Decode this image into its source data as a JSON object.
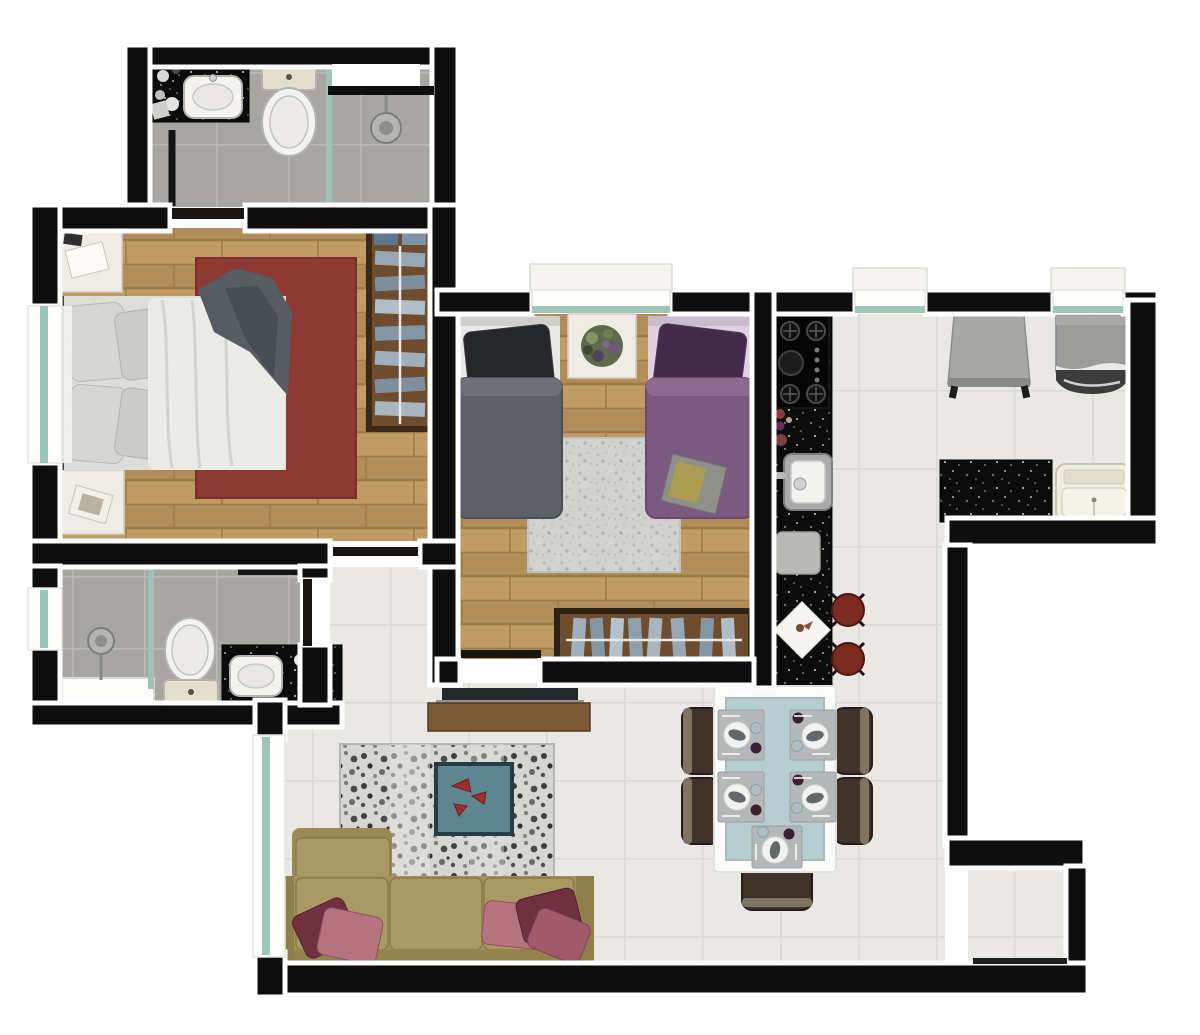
{
  "meta": {
    "type": "floor-plan",
    "description": "Top-down 3D rendered apartment floor plan, two bedrooms, two bathrooms, open kitchen-living-dining and service area",
    "visible_text": "none"
  },
  "palette": {
    "wall": "#0e0e0e",
    "wall_outline": "#ffffff",
    "glass": "#9cc4b9",
    "marble": "#f5f4f0",
    "wood": "#c09b64",
    "wood_dark": "#b28d58",
    "tile_bath": "#a8a6a3",
    "tile_light": "#e9e8e4",
    "rug_red": "#8c3a33",
    "rug_gray": "#d2d2d0",
    "sofa": "#a3935f",
    "pillow_dark": "#6f3040",
    "pillow_light": "#b3737f",
    "bed_gray_duvet": "#5e6067",
    "bed_gray_pillow": "#26272b",
    "bed_purple_duvet": "#7b5a80",
    "bed_purple_pillow": "#432a49",
    "wardrobe_frame": "#3a2a1a",
    "wardrobe_inner": "#6e4d2e",
    "counter_black": "#0c0c0c",
    "table_glass": "#b7ced0",
    "chair_brown": "#40342a",
    "stool_red": "#7c2b20",
    "appliance_gray": "#9c9c9a",
    "ottoman_teal": "#5d868f",
    "blanket_gray": "#575c63"
  },
  "rooms": [
    {
      "id": "suite-bathroom",
      "label": "Suite bathroom",
      "furniture": [
        "black vanity counter",
        "white sink",
        "toiletries",
        "toilet",
        "glass shower partition",
        "shower head",
        "wall niche",
        "door"
      ]
    },
    {
      "id": "master-bedroom",
      "label": "Master bedroom",
      "furniture": [
        "double bed with gray blanket",
        "headboard",
        "four pillows",
        "red rug",
        "nightstand with book (top)",
        "nightstand with book (bottom)",
        "open wardrobe with hanging clothes and two boxes",
        "left wall window",
        "door to hallway"
      ]
    },
    {
      "id": "second-bathroom",
      "label": "Second bathroom",
      "furniture": [
        "shower head",
        "glass shower partition",
        "white bench",
        "toilet",
        "black vanity counter with sink",
        "toiletries",
        "wall shelf",
        "small window",
        "door"
      ]
    },
    {
      "id": "hallway",
      "label": "Hallway",
      "furniture": []
    },
    {
      "id": "second-bedroom",
      "label": "Second bedroom",
      "furniture": [
        "single bed with dark gray bedding",
        "single bed with purple bedding",
        "magazine on purple bed",
        "nightstand with plant",
        "gray shag rug",
        "wardrobe with hanging clothes",
        "top wall window",
        "door"
      ]
    },
    {
      "id": "kitchen",
      "label": "Kitchen",
      "furniture": [
        "black granite counter",
        "four-burner cooktop with pan",
        "bottles",
        "stainless sink with faucet",
        "cutting board",
        "white napkin",
        "bar stool",
        "bar stool"
      ]
    },
    {
      "id": "laundry-service",
      "label": "Laundry / service area",
      "furniture": [
        "folded drying rack",
        "washing machine",
        "black counter",
        "laundry tank sink",
        "two windows"
      ]
    },
    {
      "id": "dining-area",
      "label": "Dining area",
      "furniture": [
        "white table with glass top",
        "five place settings",
        "five espresso chairs"
      ]
    },
    {
      "id": "living-room",
      "label": "Living room",
      "furniture": [
        "TV console with TV",
        "mottled gray rug",
        "teal ottoman with red decor",
        "sofa with chaise",
        "five scatter pillows",
        "floor-to-ceiling window"
      ]
    },
    {
      "id": "balcony-nook",
      "label": "Balcony nook",
      "furniture": [
        "sliding glass door line"
      ]
    }
  ],
  "counts": {
    "bedrooms": 2,
    "bathrooms": 2,
    "place_settings": 5,
    "dining_chairs": 5,
    "bar_stools": 2,
    "windows": 6
  }
}
